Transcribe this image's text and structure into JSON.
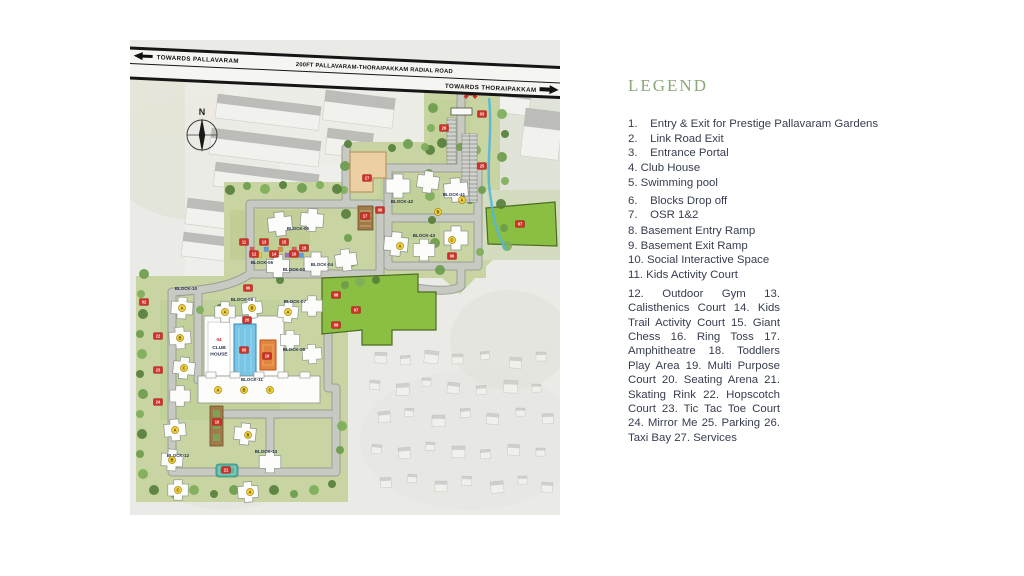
{
  "legend": {
    "title": "LEGEND",
    "items": [
      "1.    Entry & Exit for Prestige Pallavaram Gardens",
      "2.    Link Road Exit",
      "3.    Entrance Portal",
      "4. Club House",
      "5. Swimming pool",
      "6.    Blocks Drop off",
      "7.    OSR 1&2",
      "8. Basement Entry Ramp",
      "9. Basement Exit Ramp",
      "10. Social Interactive Space",
      "11. Kids Activity Court"
    ],
    "paragraph": "12. Outdoor Gym 13. Calisthenics Court 14. Kids Trail Activity Court 15. Giant Chess 16. Ring Toss 17. Amphitheatre 18. Toddlers Play Area 19. Multi Purpose Court 20. Seating Arena 21. Skating Rink 22. Hopscotch Court 23. Tic Tac Toe Court 24. Mirror Me 25. Parking 26. Taxi Bay 27. Services"
  },
  "map": {
    "road": {
      "left": "TOWARDS  PALLAVARAM",
      "center": "200FT PALLAVARAM-THORAIPAKKAM RADIAL ROAD",
      "right": "TOWARDS  THORAIPAKKAM"
    },
    "compass": "N",
    "club_house": {
      "number": "04",
      "line1": "CLUB",
      "line2": "HOUSE"
    },
    "colors": {
      "badge": "#d22f27",
      "badge_edge": "#7d1510",
      "letter": "#f6d53b",
      "letter_edge": "#a3831a",
      "green": "#8bbf44",
      "green_edge": "#4c6b1f",
      "trees": [
        "#6d9c4c",
        "#7eae59",
        "#567f3b"
      ]
    },
    "block_labels": [
      [
        "BLOCK-42",
        272,
        163
      ],
      [
        "BLOCK-41",
        324,
        156
      ],
      [
        "BLOCK-43",
        294,
        197
      ],
      [
        "BLOCK-05",
        168,
        190
      ],
      [
        "BLOCK-06",
        132,
        224
      ],
      [
        "BLOCK-03",
        164,
        231
      ],
      [
        "BLOCK-04",
        192,
        226
      ],
      [
        "BLOCK-10",
        56,
        250
      ],
      [
        "BLOCK-09",
        112,
        261
      ],
      [
        "BLOCK-07",
        165,
        263
      ],
      [
        "BLOCK-08",
        164,
        311
      ],
      [
        "BLOCK-11",
        122,
        341
      ],
      [
        "BLOCK-12",
        48,
        417
      ],
      [
        "BLOCK-13",
        136,
        413
      ]
    ],
    "towers": [
      [
        268,
        146,
        1,
        0
      ],
      [
        298,
        142,
        0.9,
        8
      ],
      [
        326,
        150,
        1,
        -5
      ],
      [
        266,
        204,
        1,
        5
      ],
      [
        294,
        210,
        0.9,
        0
      ],
      [
        326,
        198,
        1,
        0
      ],
      [
        150,
        184,
        1,
        -6
      ],
      [
        182,
        180,
        0.95,
        5
      ],
      [
        148,
        226,
        0.95,
        0
      ],
      [
        186,
        224,
        1,
        0
      ],
      [
        216,
        220,
        0.9,
        -8
      ],
      [
        52,
        268,
        0.9,
        4
      ],
      [
        50,
        298,
        0.9,
        -4
      ],
      [
        54,
        328,
        0.9,
        6
      ],
      [
        50,
        356,
        0.85,
        0
      ],
      [
        95,
        272,
        0.85,
        0
      ],
      [
        122,
        268,
        0.85,
        -6
      ],
      [
        158,
        272,
        0.85,
        5
      ],
      [
        182,
        266,
        0.85,
        0
      ],
      [
        160,
        300,
        0.8,
        0
      ],
      [
        182,
        314,
        0.8,
        -5
      ],
      [
        45,
        390,
        0.9,
        -5
      ],
      [
        42,
        420,
        0.9,
        4
      ],
      [
        48,
        450,
        0.85,
        0
      ],
      [
        115,
        394,
        0.9,
        6
      ],
      [
        140,
        422,
        0.9,
        0
      ],
      [
        118,
        452,
        0.85,
        -4
      ]
    ],
    "badges": [
      [
        "01",
        341,
        52
      ],
      [
        "03",
        352,
        74
      ],
      [
        "26",
        314,
        88
      ],
      [
        "25",
        352,
        126
      ],
      [
        "06",
        322,
        216
      ],
      [
        "06",
        250,
        170
      ],
      [
        "06",
        118,
        248
      ],
      [
        "07",
        390,
        184
      ],
      [
        "07",
        226,
        270
      ],
      [
        "08",
        206,
        255
      ],
      [
        "09",
        206,
        285
      ],
      [
        "10",
        87,
        382
      ],
      [
        "11",
        114,
        202
      ],
      [
        "12",
        124,
        214
      ],
      [
        "13",
        134,
        202
      ],
      [
        "14",
        144,
        214
      ],
      [
        "15",
        154,
        202
      ],
      [
        "16",
        164,
        214
      ],
      [
        "18",
        174,
        208
      ],
      [
        "17",
        235,
        176
      ],
      [
        "27",
        237,
        138
      ],
      [
        "19",
        137,
        316
      ],
      [
        "20",
        117,
        280
      ],
      [
        "21",
        96,
        430
      ],
      [
        "22",
        28,
        296
      ],
      [
        "23",
        28,
        330
      ],
      [
        "24",
        28,
        362
      ],
      [
        "05",
        114,
        310
      ],
      [
        "02",
        14,
        262
      ]
    ],
    "letters": [
      [
        "A",
        332,
        160
      ],
      [
        "B",
        308,
        172
      ],
      [
        "C",
        322,
        200
      ],
      [
        "A",
        270,
        206
      ],
      [
        "A",
        52,
        268
      ],
      [
        "B",
        50,
        298
      ],
      [
        "C",
        54,
        328
      ],
      [
        "A",
        95,
        272
      ],
      [
        "B",
        122,
        268
      ],
      [
        "A",
        158,
        272
      ],
      [
        "A",
        88,
        350
      ],
      [
        "B",
        114,
        350
      ],
      [
        "C",
        140,
        350
      ],
      [
        "A",
        45,
        390
      ],
      [
        "B",
        42,
        420
      ],
      [
        "C",
        48,
        450
      ],
      [
        "B",
        118,
        395
      ],
      [
        "A",
        120,
        452
      ]
    ],
    "trees": [
      [
        303,
        68,
        5
      ],
      [
        301,
        88,
        4
      ],
      [
        300,
        110,
        5
      ],
      [
        299,
        133,
        4
      ],
      [
        300,
        156,
        5
      ],
      [
        302,
        180,
        4
      ],
      [
        305,
        203,
        5
      ],
      [
        372,
        74,
        5
      ],
      [
        375,
        94,
        4
      ],
      [
        372,
        117,
        5
      ],
      [
        375,
        141,
        4
      ],
      [
        371,
        164,
        5
      ],
      [
        374,
        188,
        4
      ],
      [
        377,
        206,
        5
      ],
      [
        262,
        108,
        4
      ],
      [
        278,
        104,
        5
      ],
      [
        295,
        107,
        4
      ],
      [
        312,
        103,
        5
      ],
      [
        330,
        107,
        4
      ],
      [
        346,
        110,
        5
      ],
      [
        218,
        104,
        4
      ],
      [
        215,
        126,
        5
      ],
      [
        214,
        150,
        4
      ],
      [
        216,
        174,
        5
      ],
      [
        218,
        198,
        4
      ],
      [
        222,
        222,
        5
      ],
      [
        100,
        150,
        5
      ],
      [
        117,
        146,
        4
      ],
      [
        135,
        149,
        5
      ],
      [
        153,
        145,
        4
      ],
      [
        172,
        148,
        5
      ],
      [
        190,
        145,
        4
      ],
      [
        207,
        149,
        5
      ],
      [
        14,
        234,
        5
      ],
      [
        11,
        254,
        4
      ],
      [
        13,
        274,
        5
      ],
      [
        10,
        294,
        4
      ],
      [
        12,
        314,
        5
      ],
      [
        10,
        334,
        4
      ],
      [
        13,
        354,
        5
      ],
      [
        10,
        374,
        4
      ],
      [
        12,
        394,
        5
      ],
      [
        10,
        414,
        4
      ],
      [
        13,
        434,
        5
      ],
      [
        24,
        450,
        5
      ],
      [
        44,
        454,
        4
      ],
      [
        64,
        450,
        5
      ],
      [
        84,
        454,
        4
      ],
      [
        104,
        450,
        5
      ],
      [
        124,
        454,
        4
      ],
      [
        144,
        450,
        5
      ],
      [
        164,
        454,
        4
      ],
      [
        184,
        450,
        5
      ],
      [
        202,
        444,
        4
      ],
      [
        210,
        410,
        4
      ],
      [
        212,
        386,
        5
      ],
      [
        150,
        240,
        4
      ],
      [
        215,
        245,
        4
      ],
      [
        230,
        242,
        5
      ],
      [
        246,
        240,
        4
      ],
      [
        310,
        230,
        5
      ],
      [
        350,
        212,
        4
      ],
      [
        340,
        160,
        4
      ],
      [
        352,
        150,
        4
      ],
      [
        70,
        270,
        4
      ],
      [
        90,
        268,
        4
      ]
    ],
    "sheds": [
      [
        88,
        54,
        104,
        24,
        7
      ],
      [
        82,
        88,
        110,
        26,
        7
      ],
      [
        86,
        122,
        104,
        24,
        7
      ],
      [
        58,
        158,
        60,
        26,
        7
      ],
      [
        54,
        192,
        58,
        24,
        7
      ],
      [
        196,
        50,
        70,
        30,
        7
      ],
      [
        198,
        88,
        46,
        26,
        7
      ],
      [
        234,
        148,
        40,
        22,
        7
      ],
      [
        352,
        44,
        50,
        26,
        7
      ],
      [
        396,
        68,
        38,
        48,
        7
      ]
    ],
    "village": [
      [
        245,
        312,
        12,
        3
      ],
      [
        270,
        316,
        10,
        -4
      ],
      [
        295,
        310,
        14,
        6
      ],
      [
        322,
        314,
        11,
        0
      ],
      [
        350,
        312,
        9,
        -5
      ],
      [
        380,
        317,
        12,
        4
      ],
      [
        406,
        312,
        10,
        0
      ],
      [
        240,
        340,
        10,
        5
      ],
      [
        266,
        344,
        13,
        -3
      ],
      [
        292,
        338,
        9,
        0
      ],
      [
        318,
        342,
        12,
        6
      ],
      [
        346,
        346,
        10,
        -4
      ],
      [
        374,
        340,
        14,
        3
      ],
      [
        402,
        344,
        9,
        0
      ],
      [
        248,
        372,
        12,
        -5
      ],
      [
        275,
        368,
        9,
        4
      ],
      [
        302,
        375,
        13,
        0
      ],
      [
        330,
        369,
        10,
        -6
      ],
      [
        357,
        373,
        12,
        5
      ],
      [
        386,
        368,
        9,
        0
      ],
      [
        412,
        374,
        11,
        -3
      ],
      [
        242,
        404,
        10,
        6
      ],
      [
        268,
        408,
        12,
        -4
      ],
      [
        296,
        402,
        9,
        3
      ],
      [
        322,
        406,
        13,
        0
      ],
      [
        350,
        410,
        10,
        -5
      ],
      [
        378,
        404,
        12,
        4
      ],
      [
        406,
        408,
        9,
        0
      ],
      [
        250,
        438,
        11,
        -4
      ],
      [
        278,
        434,
        9,
        5
      ],
      [
        305,
        441,
        12,
        0
      ],
      [
        332,
        436,
        10,
        3
      ],
      [
        360,
        442,
        13,
        -6
      ],
      [
        388,
        436,
        9,
        0
      ],
      [
        412,
        442,
        11,
        4
      ]
    ],
    "kids": [
      [
        120,
        207,
        "#e05b5b"
      ],
      [
        127,
        213,
        "#f2c23e"
      ],
      [
        134,
        207,
        "#5b9be0"
      ],
      [
        141,
        213,
        "#66bb5e"
      ],
      [
        148,
        207,
        "#e08a3c"
      ],
      [
        155,
        213,
        "#9a6bd0"
      ],
      [
        162,
        207,
        "#e05b5b"
      ],
      [
        169,
        213,
        "#5b9be0"
      ]
    ]
  }
}
